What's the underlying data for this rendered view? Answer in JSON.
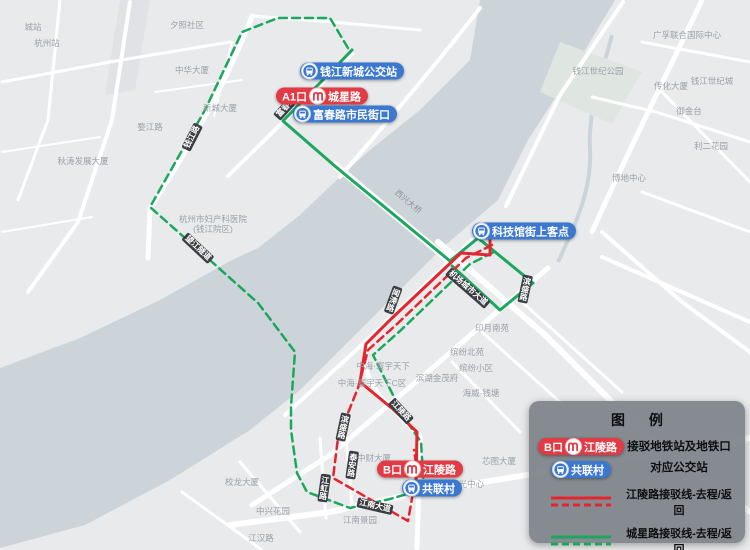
{
  "map": {
    "land_color": "#e9eaec",
    "river_color": "#ccd4d9",
    "road_color": "#ffffff"
  },
  "route_colors": {
    "green": "#1ba75d",
    "red": "#e5252e"
  },
  "stations": [
    {
      "type": "bus",
      "label": "钱江新城公交站",
      "x": 352,
      "y": 71
    },
    {
      "type": "metro",
      "exit": "A1口",
      "label": "城星路",
      "x": 322,
      "y": 96
    },
    {
      "type": "bus",
      "label": "富春路市民街口",
      "x": 345,
      "y": 114
    },
    {
      "type": "bus",
      "label": "科技馆街上客点",
      "x": 524,
      "y": 231
    },
    {
      "type": "metro",
      "exit": "B口",
      "label": "江陵路",
      "x": 420,
      "y": 469
    },
    {
      "type": "bus",
      "label": "共联村",
      "x": 432,
      "y": 488
    }
  ],
  "road_tags": [
    {
      "text": "钱江路",
      "x": 192,
      "y": 137,
      "rot": -63,
      "vertical": false,
      "dark": true
    },
    {
      "text": "富春路",
      "x": 286,
      "y": 107,
      "rot": -48,
      "vertical": false,
      "dark": true
    },
    {
      "text": "望江隧道",
      "x": 198,
      "y": 248,
      "rot": 43,
      "vertical": false,
      "dark": true
    },
    {
      "text": "西兴大桥",
      "x": 408,
      "y": 202,
      "rot": 40,
      "vertical": false,
      "dark": false
    },
    {
      "text": "闻涛路",
      "x": 393,
      "y": 300,
      "rot": 20,
      "vertical": true,
      "dark": true
    },
    {
      "text": "机场城市大道",
      "x": 468,
      "y": 288,
      "rot": 41,
      "vertical": false,
      "dark": true
    },
    {
      "text": "滨盛路",
      "x": 525,
      "y": 289,
      "rot": 12,
      "vertical": true,
      "dark": true
    },
    {
      "text": "滨盛路",
      "x": 343,
      "y": 427,
      "rot": 12,
      "vertical": true,
      "dark": true
    },
    {
      "text": "江陵路",
      "x": 401,
      "y": 411,
      "rot": 47,
      "vertical": false,
      "dark": true
    },
    {
      "text": "泰安路",
      "x": 352,
      "y": 465,
      "rot": 8,
      "vertical": true,
      "dark": true
    },
    {
      "text": "江虹路",
      "x": 324,
      "y": 488,
      "rot": 8,
      "vertical": true,
      "dark": true
    },
    {
      "text": "江南大道",
      "x": 375,
      "y": 506,
      "rot": 13,
      "vertical": false,
      "dark": true
    }
  ],
  "map_labels": [
    {
      "text": "城站",
      "x": 33,
      "y": 27
    },
    {
      "text": "杭州站",
      "x": 47,
      "y": 43
    },
    {
      "text": "夕照社区",
      "x": 187,
      "y": 25
    },
    {
      "text": "中华大厦",
      "x": 192,
      "y": 70
    },
    {
      "text": "新城大厦",
      "x": 220,
      "y": 108
    },
    {
      "text": "婺江路",
      "x": 150,
      "y": 127
    },
    {
      "text": "秋涛发展大厦",
      "x": 83,
      "y": 161
    },
    {
      "text": "杭州市妇产科医院",
      "x": 213,
      "y": 219
    },
    {
      "text": "(钱江院区)",
      "x": 213,
      "y": 229
    },
    {
      "text": "钱江世纪公园",
      "x": 598,
      "y": 71
    },
    {
      "text": "广孚联合国际中心",
      "x": 687,
      "y": 35
    },
    {
      "text": "钱江世纪城",
      "x": 712,
      "y": 81
    },
    {
      "text": "传化大厦",
      "x": 671,
      "y": 86
    },
    {
      "text": "御金台",
      "x": 689,
      "y": 111
    },
    {
      "text": "利二花园",
      "x": 711,
      "y": 146
    },
    {
      "text": "博地中心",
      "x": 629,
      "y": 178
    },
    {
      "text": "中海·寰宇天下",
      "x": 383,
      "y": 366
    },
    {
      "text": "中海·寰宇天下C区",
      "x": 372,
      "y": 383
    },
    {
      "text": "滨湖金茂府",
      "x": 437,
      "y": 378
    },
    {
      "text": "海威·钱塘",
      "x": 481,
      "y": 393
    },
    {
      "text": "印月南苑",
      "x": 492,
      "y": 328
    },
    {
      "text": "缤纷北苑",
      "x": 467,
      "y": 352
    },
    {
      "text": "缤纷小区",
      "x": 476,
      "y": 368
    },
    {
      "text": "中财大厦",
      "x": 374,
      "y": 458
    },
    {
      "text": "芯图大厦",
      "x": 499,
      "y": 461
    },
    {
      "text": "聚光中心",
      "x": 467,
      "y": 484
    },
    {
      "text": "校龙大厦",
      "x": 242,
      "y": 482
    },
    {
      "text": "中兴花园",
      "x": 273,
      "y": 511
    },
    {
      "text": "江南景园",
      "x": 360,
      "y": 520
    },
    {
      "text": "江汉路",
      "x": 261,
      "y": 538
    }
  ],
  "legend": {
    "title": "图 例",
    "metro_example": {
      "exit": "B口",
      "name": "江陵路"
    },
    "bus_example": {
      "name": "共联村"
    },
    "desc_line1": "接驳地铁站及地铁口",
    "desc_line2": "对应公交站",
    "red_route_label": "江陵路接驳线-去程/返回",
    "green_route_label": "城星路接驳线-去程/返回"
  },
  "badge_colors": {
    "metro_red": "#e23b45",
    "bus_blue": "#3c78d0"
  }
}
